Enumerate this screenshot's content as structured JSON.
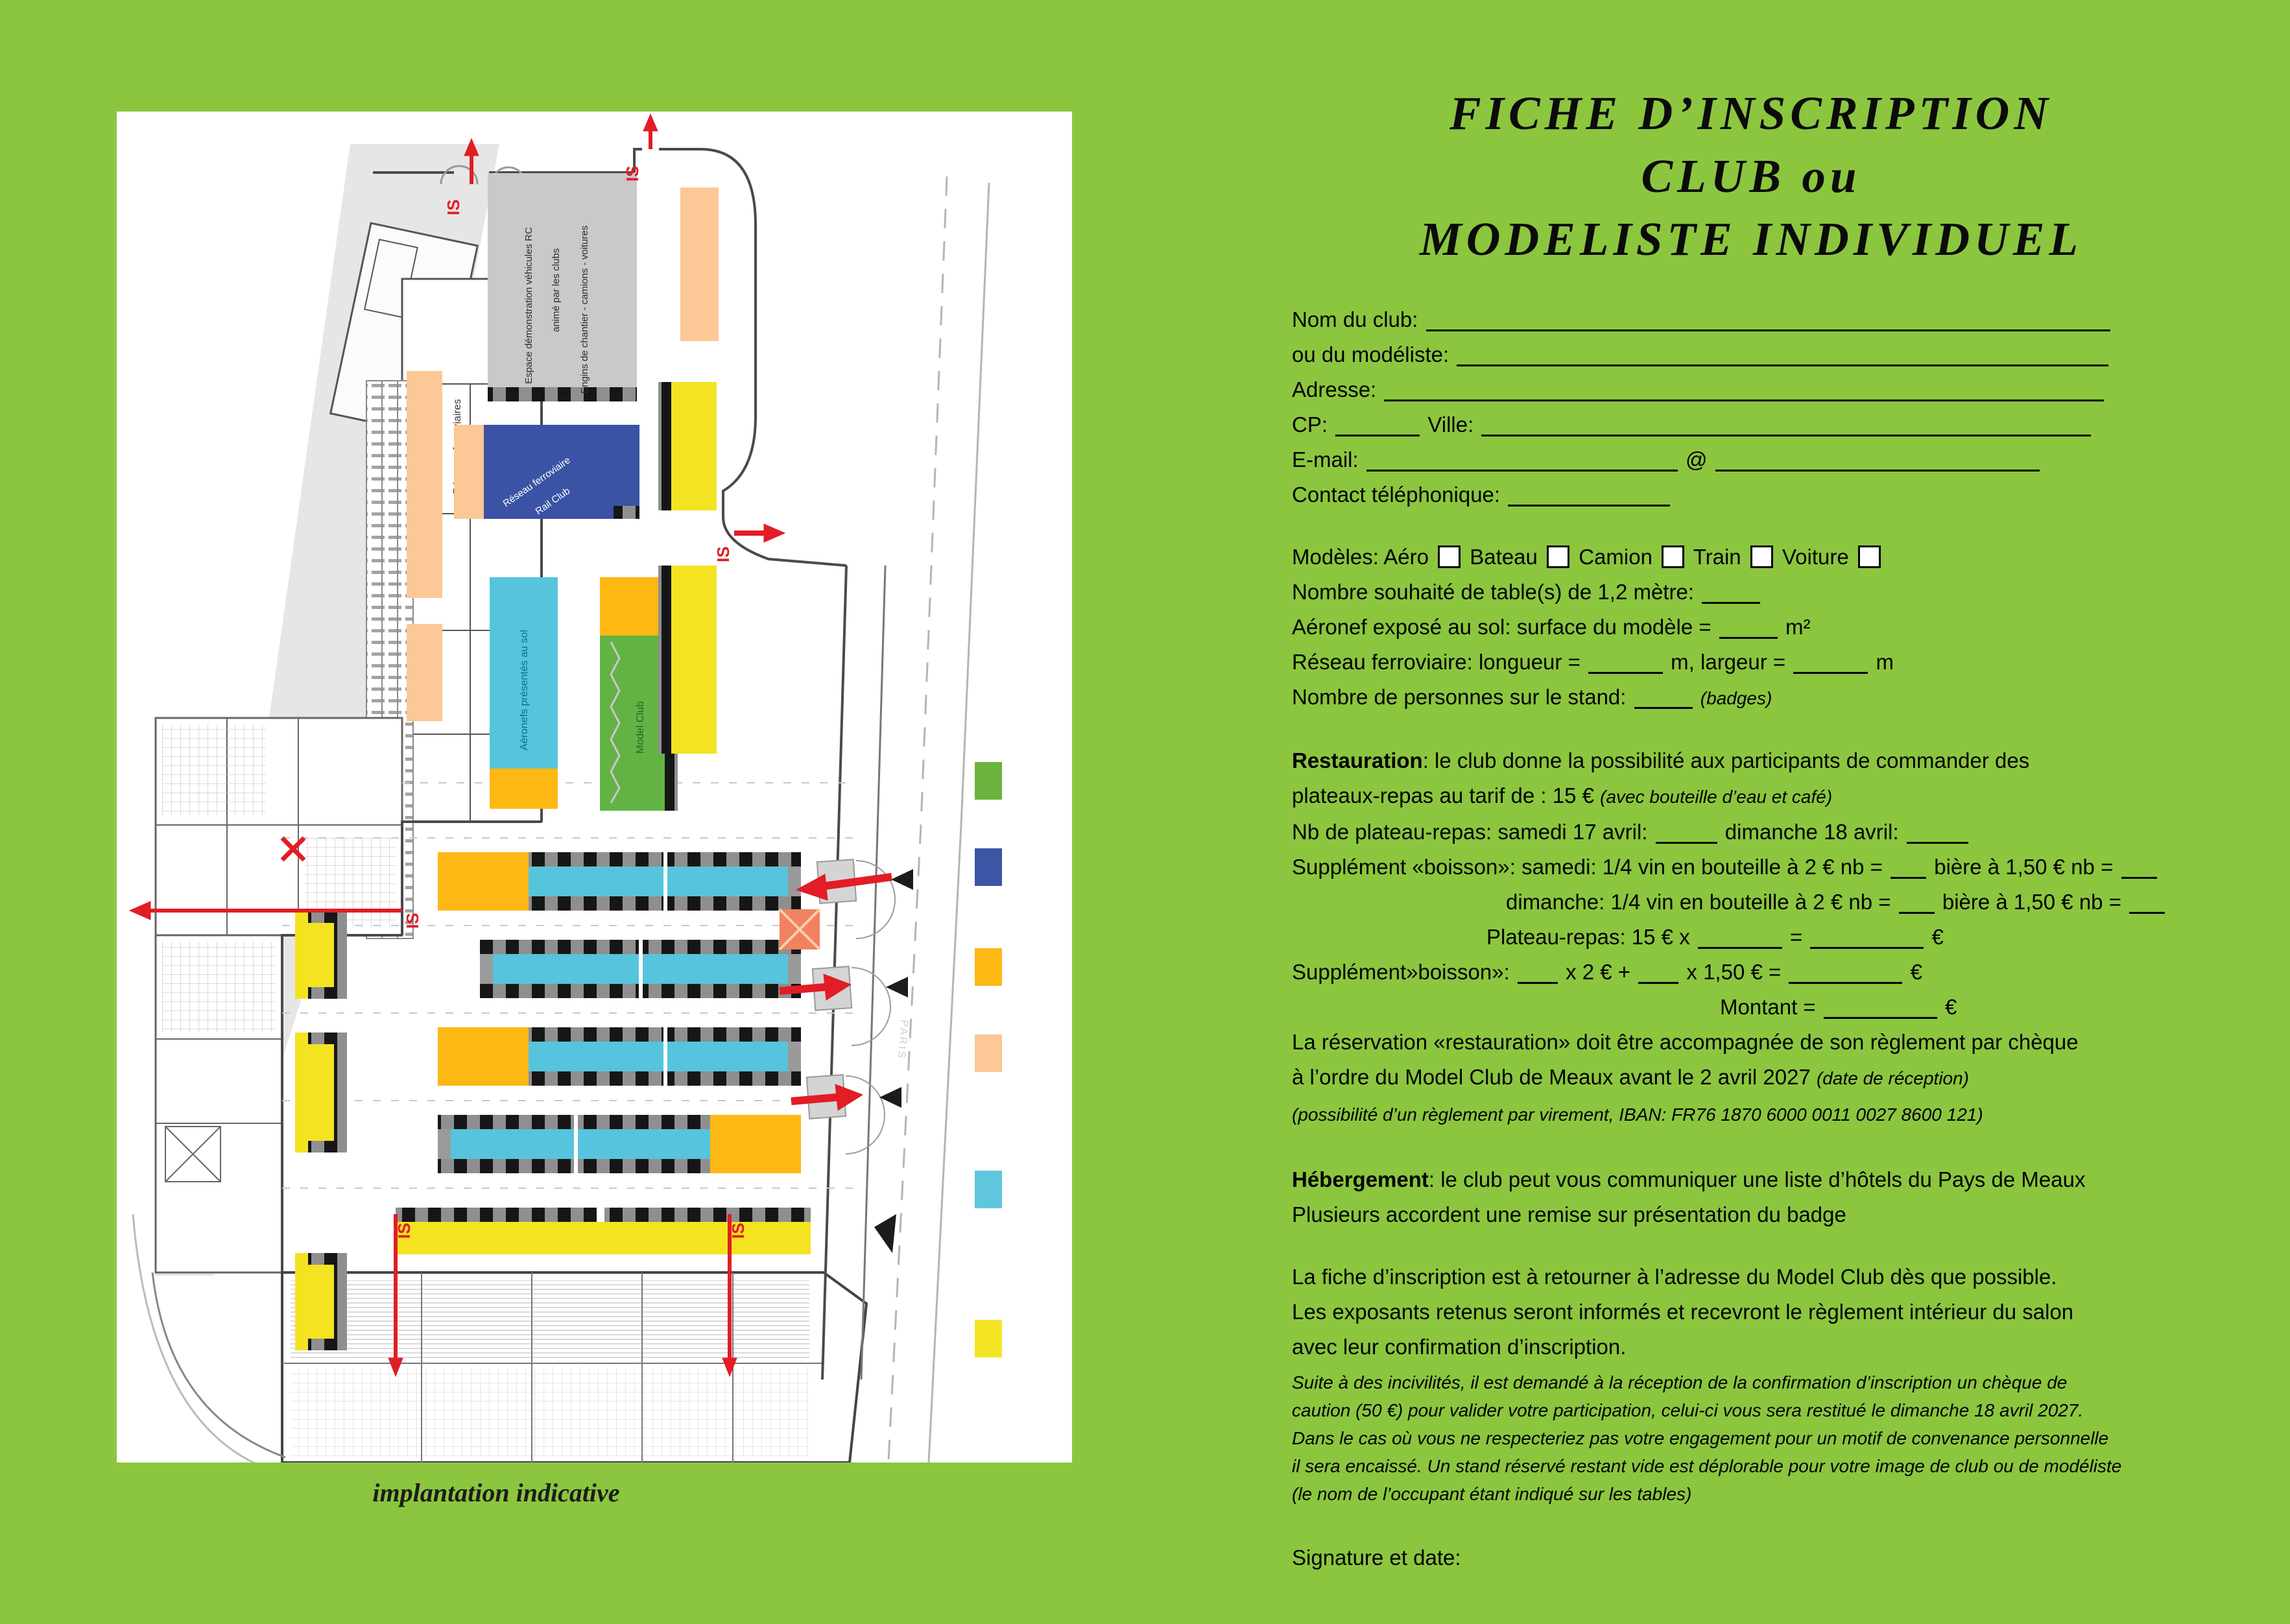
{
  "title": {
    "l1": "FICHE D’INSCRIPTION",
    "l2": "CLUB ou",
    "l3": "MODELISTE INDIVIDUEL"
  },
  "page": {
    "caption": "implantation indicative"
  },
  "plan": {
    "labels": {
      "espace1": "Espace démonstration véhicules RC",
      "espace2": "animé par les clubs",
      "espace3": "Engins de chantier - camions - voitures",
      "reseaux": "Réseaux ferroviaires",
      "rail1": "Réseau ferroviaire",
      "rail2": "Rail Club",
      "aeronefs": "Aéronefs présentés au sol",
      "model_club": "Model Club",
      "is": "IS",
      "paris": "PARIS"
    },
    "legend_colors": [
      "#6cb33e",
      "#3a56a5",
      "#fdb813",
      "#fbc896",
      "#5fc6de",
      "#f5e525"
    ]
  },
  "form": {
    "lines": [
      {
        "segs": [
          {
            "t": "Nom du club: "
          },
          {
            "u": 1055
          }
        ]
      },
      {
        "segs": [
          {
            "t": "ou du modéliste: "
          },
          {
            "u": 1005
          }
        ]
      },
      {
        "segs": [
          {
            "t": "Adresse: "
          },
          {
            "u": 1110
          }
        ]
      },
      {
        "segs": [
          {
            "t": "CP: "
          },
          {
            "u": 130
          },
          {
            "t": "  Ville: "
          },
          {
            "u": 940
          }
        ]
      },
      {
        "segs": [
          {
            "t": "E-mail: "
          },
          {
            "u": 480
          },
          {
            "t": " @ "
          },
          {
            "u": 500
          }
        ]
      },
      {
        "segs": [
          {
            "t": "Contact téléphonique: "
          },
          {
            "u": 250
          }
        ]
      },
      {
        "mt": 42,
        "segs": [
          {
            "t": "Modèles: Aéro "
          },
          {
            "box": 1
          },
          {
            "t": " Bateau "
          },
          {
            "box": 1
          },
          {
            "t": " Camion "
          },
          {
            "box": 1
          },
          {
            "t": "  Train "
          },
          {
            "box": 1
          },
          {
            "t": " Voiture "
          },
          {
            "box": 1
          }
        ]
      },
      {
        "segs": [
          {
            "t": "Nombre souhaité de table(s) de 1,2 mètre: "
          },
          {
            "u": 90
          }
        ]
      },
      {
        "segs": [
          {
            "t": "Aéronef exposé au sol: surface du modèle = "
          },
          {
            "u": 90
          },
          {
            "t": " m²"
          }
        ]
      },
      {
        "segs": [
          {
            "t": "Réseau ferroviaire: longueur = "
          },
          {
            "u": 115
          },
          {
            "t": " m, largeur = "
          },
          {
            "u": 115
          },
          {
            "t": " m"
          }
        ]
      },
      {
        "segs": [
          {
            "t": "Nombre de personnes sur le stand: "
          },
          {
            "u": 90
          },
          {
            "t": " "
          },
          {
            "t": "(badges)",
            "i": 1,
            "s": 1
          }
        ]
      },
      {
        "mt": 42,
        "segs": [
          {
            "t": "Restauration",
            "b": 1
          },
          {
            "t": ": le club donne la possibilité aux participants de commander des"
          }
        ]
      },
      {
        "segs": [
          {
            "t": "plateaux-repas au tarif de : 15 € "
          },
          {
            "t": "(avec bouteille d’eau et café)",
            "i": 1,
            "s": 1
          }
        ]
      },
      {
        "segs": [
          {
            "t": "Nb de plateau-repas: samedi 17 avril: "
          },
          {
            "u": 95
          },
          {
            "t": " dimanche 18 avril: "
          },
          {
            "u": 95
          }
        ]
      },
      {
        "segs": [
          {
            "t": "Supplément «boisson»: samedi: 1/4 vin en bouteille à 2 € nb = "
          },
          {
            "u": 55
          },
          {
            "t": "  bière à 1,50 € nb = "
          },
          {
            "u": 55
          }
        ]
      },
      {
        "ml": 330,
        "segs": [
          {
            "t": "dimanche: 1/4 vin en bouteille à 2 € nb = "
          },
          {
            "u": 55
          },
          {
            "t": "  bière à 1,50 € nb = "
          },
          {
            "u": 55
          }
        ]
      },
      {
        "ml": 300,
        "segs": [
          {
            "t": "Plateau-repas: 15 € x "
          },
          {
            "u": 130
          },
          {
            "t": " = "
          },
          {
            "u": 175
          },
          {
            "t": " €"
          }
        ]
      },
      {
        "segs": [
          {
            "t": "Supplément»boisson»: "
          },
          {
            "u": 62
          },
          {
            "t": " x 2 € + "
          },
          {
            "u": 62
          },
          {
            "t": " x 1,50 € = "
          },
          {
            "u": 175
          },
          {
            "t": " €"
          }
        ]
      },
      {
        "ml": 660,
        "segs": [
          {
            "t": "Montant = "
          },
          {
            "u": 175
          },
          {
            "t": " €"
          }
        ]
      },
      {
        "segs": [
          {
            "t": "La réservation «restauration» doit être accompagnée de son règlement par chèque"
          }
        ]
      },
      {
        "segs": [
          {
            "t": "à l’ordre du Model Club de Meaux avant le 2 avril 2027 "
          },
          {
            "t": "(date de réception)",
            "i": 1,
            "s": 1
          }
        ]
      },
      {
        "segs": [
          {
            "t": "(possibilité d’un règlement par virement, IBAN: FR76 1870 6000 0011 0027 8600 121)",
            "i": 1,
            "s": 1
          }
        ]
      },
      {
        "mt": 46,
        "segs": [
          {
            "t": "Hébergement",
            "b": 1
          },
          {
            "t": ": le club peut vous communiquer une liste d’hôtels du Pays de Meaux"
          }
        ]
      },
      {
        "segs": [
          {
            "t": "Plusieurs accordent une remise sur présentation du badge"
          }
        ]
      },
      {
        "mt": 42,
        "segs": [
          {
            "t": "La fiche d’inscription est à retourner à l’adresse du Model Club dès que possible."
          }
        ]
      },
      {
        "segs": [
          {
            "t": "Les exposants retenus seront informés et recevront le règlement intérieur du salon"
          }
        ]
      },
      {
        "segs": [
          {
            "t": "avec leur confirmation d’inscription."
          }
        ]
      },
      {
        "cls": "fine",
        "mt": 6,
        "segs": [
          {
            "t": "Suite à des incivilités, il est demandé à la réception de la confirmation d’inscription un chèque de"
          }
        ]
      },
      {
        "cls": "fine",
        "segs": [
          {
            "t": "caution (50 €) pour valider votre participation, celui-ci vous sera restitué le dimanche 18 avril 2027."
          }
        ]
      },
      {
        "cls": "fine",
        "segs": [
          {
            "t": "Dans le cas où vous ne respecteriez pas votre engagement pour un motif de convenance personnelle"
          }
        ]
      },
      {
        "cls": "fine",
        "segs": [
          {
            "t": "il sera encaissé. Un stand réservé restant vide est déplorable pour votre image de club ou de modéliste"
          }
        ]
      },
      {
        "cls": "fine",
        "segs": [
          {
            "t": "(le nom de l’occupant étant indiqué sur les tables)"
          }
        ]
      },
      {
        "mt": 50,
        "segs": [
          {
            "t": "Signature et date:"
          }
        ]
      }
    ]
  }
}
